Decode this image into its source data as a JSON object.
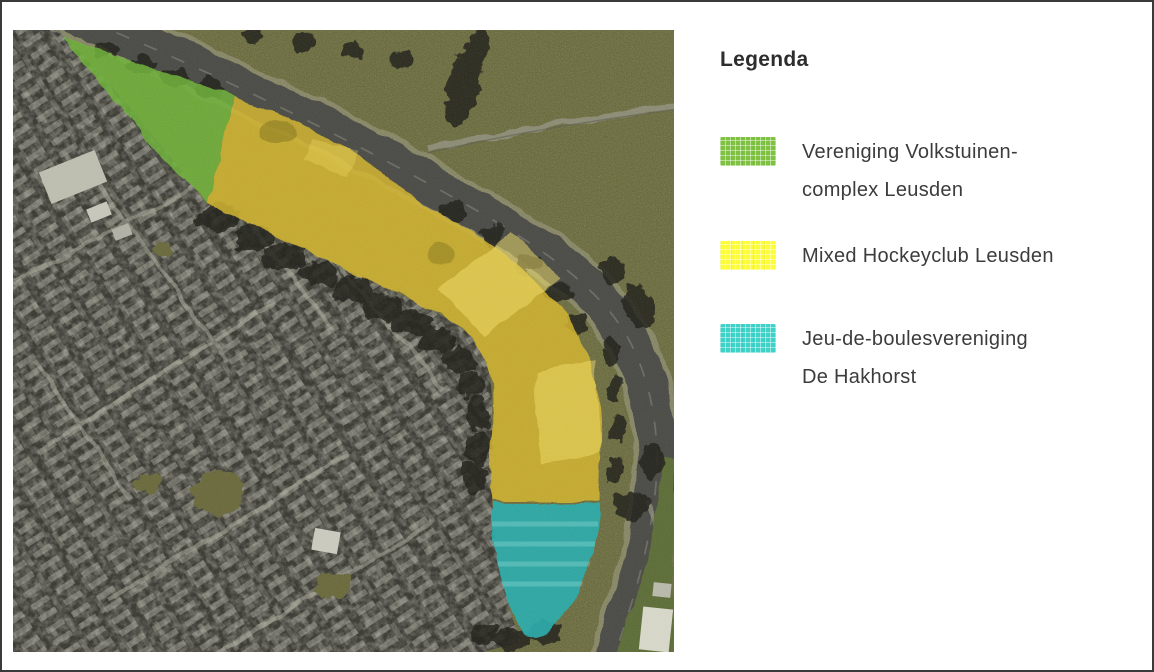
{
  "page": {
    "background": "#ffffff",
    "border_color": "#3a3a3a"
  },
  "map": {
    "kind": "aerial-photo-with-overlays",
    "overlay_colors": {
      "allotment_green": "#6fb23a",
      "hockey_yellow": "#d2b42e",
      "boules_cyan": "#2aacae"
    }
  },
  "legend": {
    "title": "Legenda",
    "items": [
      {
        "label_lines": [
          "Vereniging Volkstuinen-",
          "complex Leusden"
        ],
        "color": "#7fc241"
      },
      {
        "label_lines": [
          "Mixed Hockeyclub Leusden"
        ],
        "color": "#fcfc38"
      },
      {
        "label_lines": [
          "Jeu-de-boulesvereniging",
          "De Hakhorst"
        ],
        "color": "#3fd2c8"
      }
    ]
  }
}
